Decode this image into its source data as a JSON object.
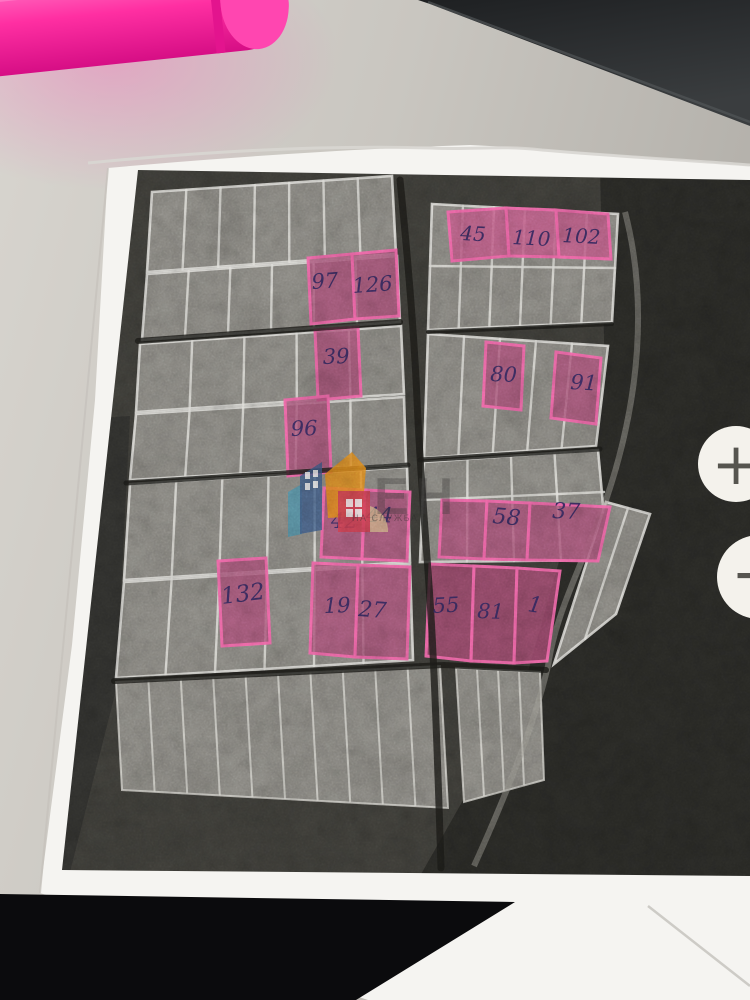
{
  "scene": {
    "desk": {
      "name": "office desk surface",
      "color": "#c9c6c0"
    },
    "pen": {
      "name": "pink highlighter marker",
      "color": "#ff2fa2"
    },
    "dark_object": {
      "name": "dark object at top right",
      "color": "#26282a"
    },
    "paper": {
      "name": "printed aerial parcel map sheet",
      "color": "#f5f4f1"
    },
    "highlight_color": "#e4579a",
    "ink_color": "#352a63"
  },
  "map": {
    "watermark": {
      "logo": "houses-logo",
      "text_main": "ЕН",
      "text_sub": "НА СЛУЖБА"
    },
    "plots": [
      {
        "label": "97"
      },
      {
        "label": "126"
      },
      {
        "label": "45"
      },
      {
        "label": "110"
      },
      {
        "label": "102"
      },
      {
        "label": "39"
      },
      {
        "label": "80"
      },
      {
        "label": "91"
      },
      {
        "label": "96"
      },
      {
        "label": "42"
      },
      {
        "label": "44"
      },
      {
        "label": "58"
      },
      {
        "label": "37"
      },
      {
        "label": "132"
      },
      {
        "label": "19"
      },
      {
        "label": "27"
      },
      {
        "label": "55"
      },
      {
        "label": "81"
      },
      {
        "label": "1"
      }
    ]
  },
  "controls": {
    "zoom_in": "+",
    "zoom_out": "−"
  }
}
